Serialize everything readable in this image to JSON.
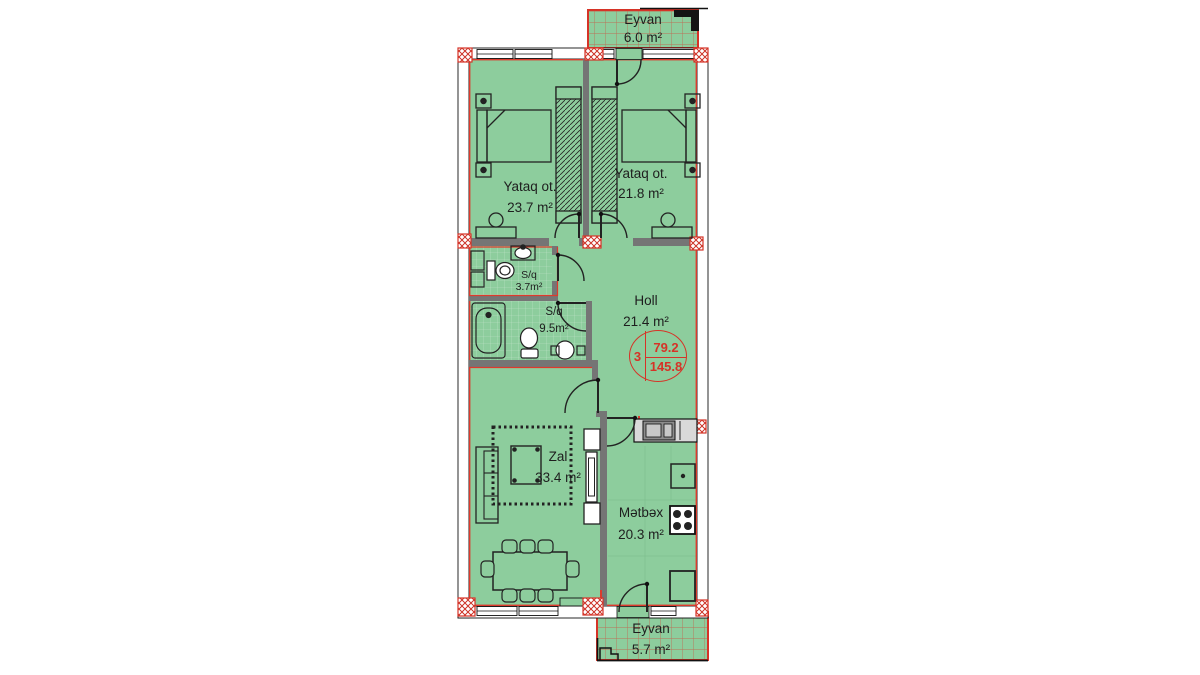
{
  "plan": {
    "rooms": [
      {
        "id": "eyvan-top",
        "name": "Eyvan",
        "area": "6.0 m²"
      },
      {
        "id": "yataq-left",
        "name": "Yataq ot.",
        "area": "23.7 m²"
      },
      {
        "id": "yataq-right",
        "name": "Yataq ot.",
        "area": "21.8 m²"
      },
      {
        "id": "sq-small",
        "name": "S/q",
        "area": "3.7m²"
      },
      {
        "id": "sq-large",
        "name": "S/q",
        "area": "9.5m²"
      },
      {
        "id": "holl",
        "name": "Holl",
        "area": "21.4 m²"
      },
      {
        "id": "zal",
        "name": "Zal",
        "area": "33.4 m²"
      },
      {
        "id": "metbex",
        "name": "Mətbəx",
        "area": "20.3 m²"
      },
      {
        "id": "eyvan-bottom",
        "name": "Eyvan",
        "area": "5.7 m²"
      }
    ],
    "stamp": {
      "flat_number": "3",
      "upper_area": "79.2",
      "lower_area": "145.8"
    },
    "colors": {
      "room_fill": "#8dcd9d",
      "bath_tile": "#ffffff",
      "wall_gray": "#757575",
      "accent_red": "#d63327",
      "line_black": "#1c1c1c"
    }
  }
}
